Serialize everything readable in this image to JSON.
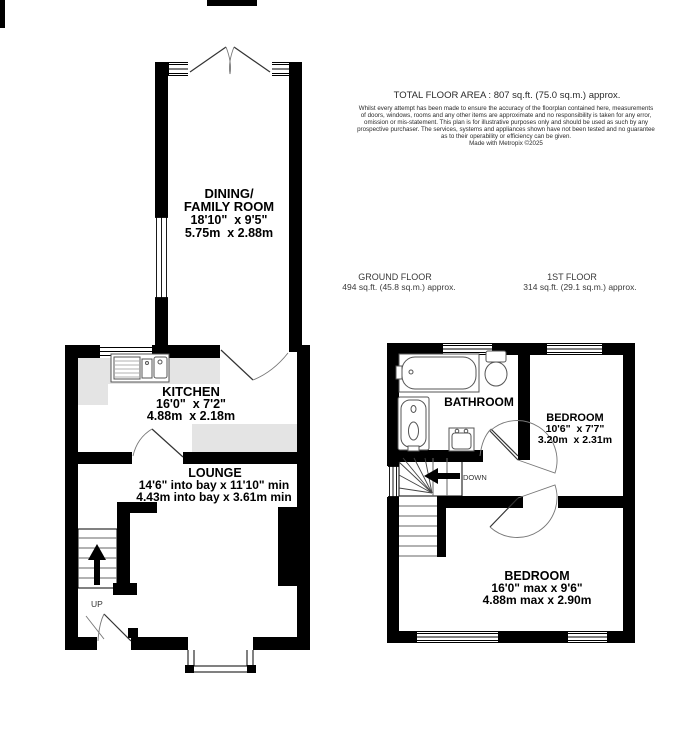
{
  "header": {
    "total_area": "TOTAL FLOOR AREA : 807 sq.ft. (75.0 sq.m.) approx.",
    "disclaimer_lines": [
      "Whilst every attempt has been made to ensure the accuracy of the floorplan contained here, measurements",
      "of doors, windows, rooms and any other items are approximate and no responsibility is taken for any error,",
      "omission or mis-statement. This plan is for illustrative purposes only and should be used as such by any",
      "prospective purchaser. The services, systems and appliances shown have not been tested and no guarantee",
      "as to their operability or efficiency can be given."
    ],
    "credit": "Made with Metropix ©2025"
  },
  "floors": {
    "ground": {
      "title": "GROUND FLOOR",
      "area": "494 sq.ft. (45.8 sq.m.) approx."
    },
    "first": {
      "title": "1ST FLOOR",
      "area": "314 sq.ft. (29.1 sq.m.) approx."
    }
  },
  "rooms": {
    "dining": {
      "line1": "DINING/",
      "line2": "FAMILY ROOM",
      "imperial": "18'10\"  x 9'5\"",
      "metric": "5.75m  x 2.88m"
    },
    "kitchen": {
      "name": "KITCHEN",
      "imperial": "16'0\"  x 7'2\"",
      "metric": "4.88m  x 2.18m"
    },
    "lounge": {
      "name": "LOUNGE",
      "imperial": "14'6\" into bay x 11'10\" min",
      "metric": "4.43m into bay x 3.61m min"
    },
    "bathroom": {
      "name": "BATHROOM"
    },
    "bedroom1": {
      "name": "BEDROOM",
      "imperial": "10'6\"  x 7'7\"",
      "metric": "3.20m  x 2.31m"
    },
    "bedroom2": {
      "name": "BEDROOM",
      "imperial": "16'0\" max x 9'6\"",
      "metric": "4.88m max x 2.90m"
    }
  },
  "stairs": {
    "up": "UP",
    "down": "DOWN"
  },
  "colors": {
    "wall": "#000000",
    "counter": "#e4e4e4",
    "background": "#ffffff",
    "text": "#000000"
  }
}
